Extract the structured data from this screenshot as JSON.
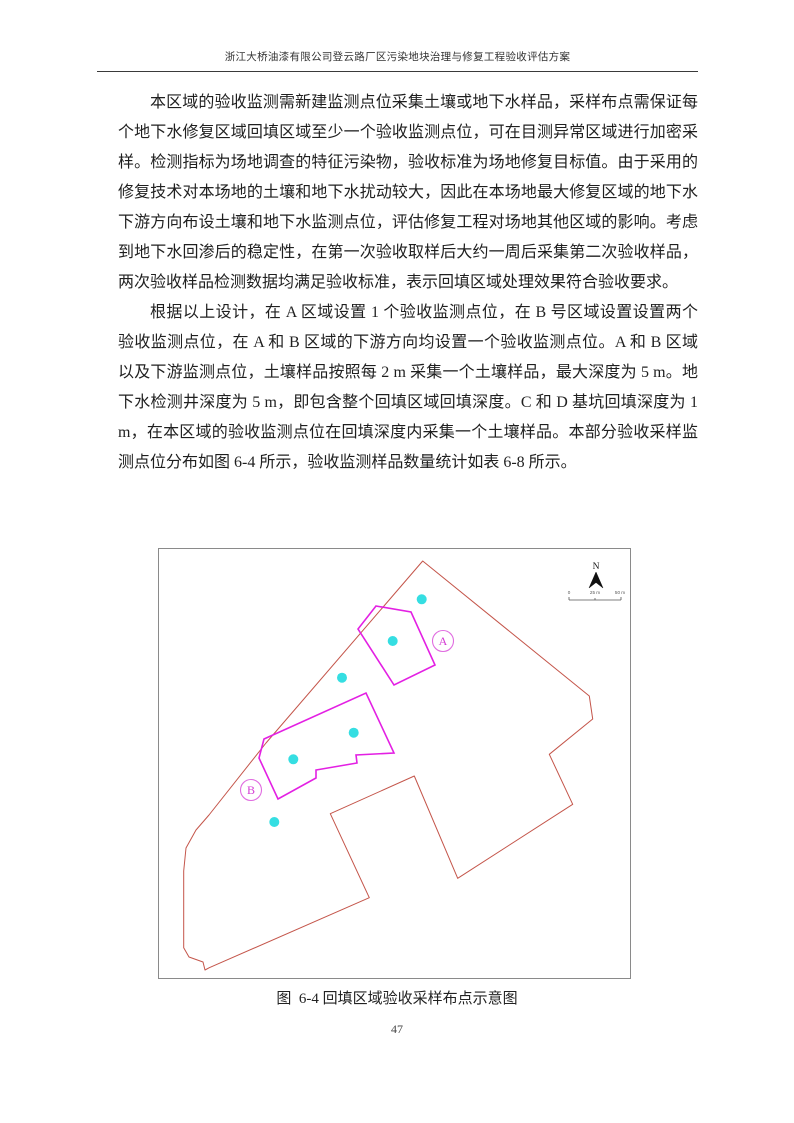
{
  "page": {
    "header": "浙江大桥油漆有限公司登云路厂区污染地块治理与修复工程验收评估方案",
    "page_number": "47"
  },
  "content": {
    "paragraph1": "本区域的验收监测需新建监测点位采集土壤或地下水样品，采样布点需保证每个地下水修复区域回填区域至少一个验收监测点位，可在目测异常区域进行加密采样。检测指标为场地调查的特征污染物，验收标准为场地修复目标值。由于采用的修复技术对本场地的土壤和地下水扰动较大，因此在本场地最大修复区域的地下水下游方向布设土壤和地下水监测点位，评估修复工程对场地其他区域的影响。考虑到地下水回渗后的稳定性，在第一次验收取样后大约一周后采集第二次验收样品，两次验收样品检测数据均满足验收标准，表示回填区域处理效果符合验收要求。",
    "paragraph2": "根据以上设计，在 A 区域设置 1 个验收监测点位，在 B 号区域设置设置两个验收监测点位，在 A 和 B 区域的下游方向均设置一个验收监测点位。A 和 B 区域以及下游监测点位，土壤样品按照每 2 m 采集一个土壤样品，最大深度为 5 m。地下水检测井深度为 5 m，即包含整个回填区域回填深度。C 和 D 基坑回填深度为 1 m，在本区域的验收监测点位在回填深度内采集一个土壤样品。本部分验收采样监测点位分布如图  6-4 所示，验收监测样品数量统计如表  6-8 所示。"
  },
  "figure": {
    "caption": "图  6-4 回填区域验收采样布点示意图",
    "north_label": "N",
    "scale": {
      "zero": "0",
      "mid": "25 m",
      "max": "50 m"
    },
    "labels": {
      "region_a": "A",
      "region_b": "B"
    },
    "colors": {
      "site_boundary": "#c4554a",
      "remediation_area": "#e320e3",
      "sample_point": "#35dee2",
      "region_label": "#e06ce0",
      "region_label_text": "#d43ad4"
    },
    "map": {
      "site_boundary": [
        [
          263.7,
          12
        ],
        [
          430.3,
          147
        ],
        [
          433.7,
          170
        ],
        [
          390.3,
          205.3
        ],
        [
          413.7,
          255.3
        ],
        [
          298.7,
          329.3
        ],
        [
          255.3,
          227
        ],
        [
          171.3,
          264.7
        ],
        [
          210.3,
          348.7
        ],
        [
          50.3,
          418.7
        ],
        [
          46,
          421
        ],
        [
          44,
          413
        ],
        [
          30,
          408
        ],
        [
          24.7,
          398.7
        ],
        [
          24.7,
          322
        ],
        [
          27,
          299
        ],
        [
          37,
          281
        ],
        [
          50,
          266
        ],
        [
          107,
          194
        ]
      ],
      "area_a": [
        [
          217,
          57
        ],
        [
          252,
          63
        ],
        [
          276,
          116
        ],
        [
          235,
          136
        ],
        [
          199,
          80
        ]
      ],
      "area_b": [
        [
          105,
          190
        ],
        [
          207,
          144
        ],
        [
          235,
          204
        ],
        [
          197,
          206
        ],
        [
          198,
          214
        ],
        [
          157,
          221
        ],
        [
          157,
          229
        ],
        [
          119,
          250
        ],
        [
          100,
          209
        ]
      ],
      "sample_points": [
        [
          262.7,
          50.3
        ],
        [
          233.7,
          92
        ],
        [
          183,
          128.7
        ],
        [
          194.7,
          183.7
        ],
        [
          134.3,
          210.3
        ],
        [
          115.3,
          273
        ]
      ],
      "sample_point_radius": 5,
      "label_a_pos": [
        284,
        92
      ],
      "label_b_pos": [
        92,
        241
      ]
    }
  }
}
